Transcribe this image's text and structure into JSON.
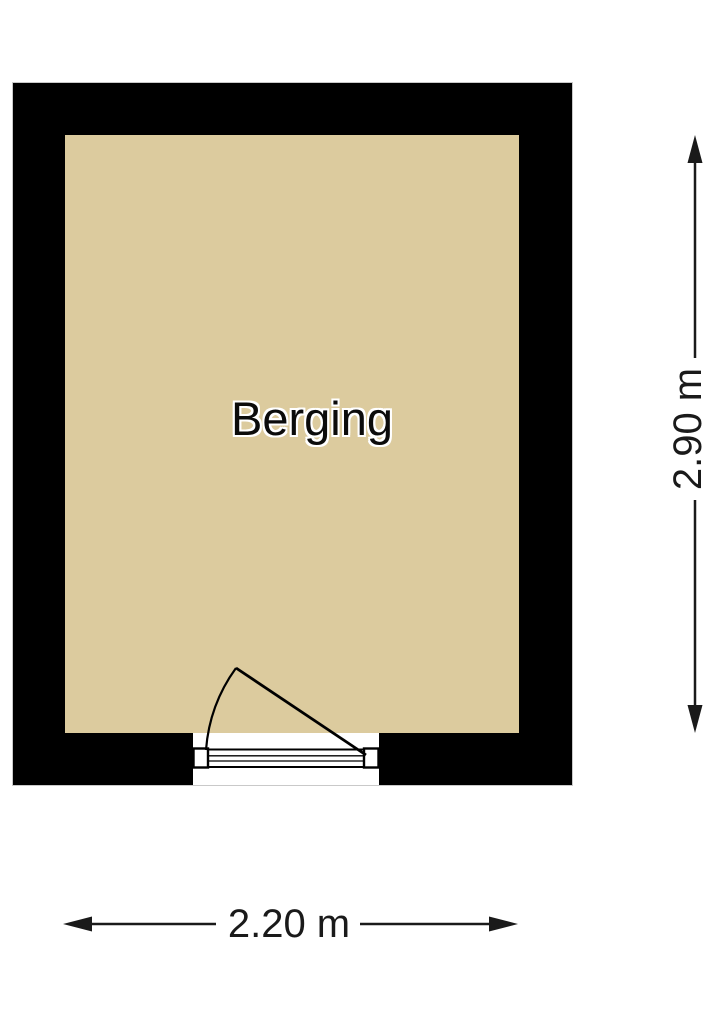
{
  "floorplan": {
    "room": {
      "label": "Berging"
    },
    "dimensions": {
      "height": "2.90 m",
      "width": "2.20 m"
    },
    "colors": {
      "wall": "#000000",
      "floor": "#dccb9e",
      "background": "#ffffff",
      "line": "#1a1a1a"
    }
  }
}
